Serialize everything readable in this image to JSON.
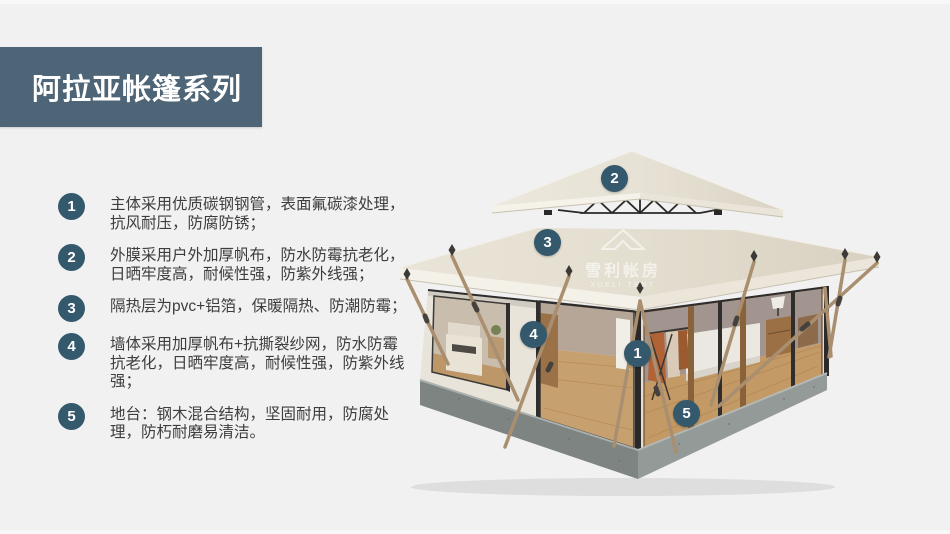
{
  "page": {
    "background_color": "#f1f1f2",
    "accent_color": "#4e6477",
    "badge_color": "#34586c"
  },
  "header": {
    "title": "阿拉亚帐篷系列"
  },
  "features": [
    {
      "num": "1",
      "text": "主体采用优质碳钢钢管，表面氟碳漆处理，抗风耐压，防腐防锈；"
    },
    {
      "num": "2",
      "text": "外膜采用户外加厚帆布，防水防霉抗老化，日晒牢度高，耐候性强，防紫外线强；"
    },
    {
      "num": "3",
      "text": "隔热层为pvc+铝箔，保暖隔热、防潮防霉；"
    },
    {
      "num": "4",
      "text": "墙体采用加厚帆布+抗撕裂纱网，防水防霉抗老化，日晒牢度高，耐候性强，防紫外线强；"
    },
    {
      "num": "5",
      "text": "地台：钢木混合结构，坚固耐用，防腐处理，防朽耐磨易清洁。"
    }
  ],
  "diagram": {
    "annotations": [
      {
        "label": "1"
      },
      {
        "label": "2"
      },
      {
        "label": "3"
      },
      {
        "label": "4"
      },
      {
        "label": "5"
      }
    ],
    "watermark": {
      "cn": "雪利帐房",
      "en": "XUELI TENT"
    }
  }
}
